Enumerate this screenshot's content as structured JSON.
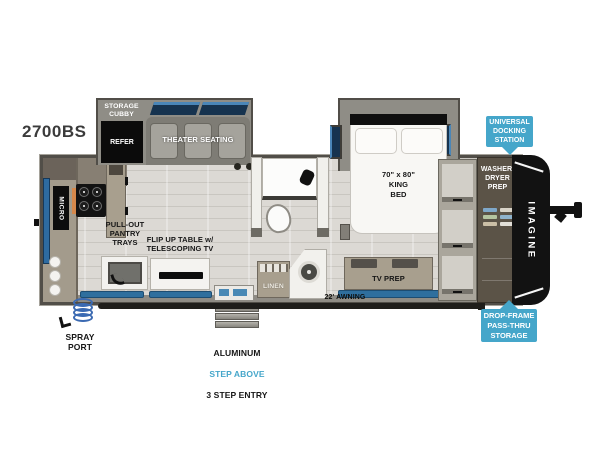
{
  "model": "2700BS",
  "badges": {
    "accessory_hitch": "ACCESSORY HITCH",
    "universal_docking_station": "UNIVERSAL\nDOCKING\nSTATION",
    "drop_frame_pass_thru_storage": "DROP-FRAME\nPASS-THRU\nSTORAGE"
  },
  "features": {
    "storage_cubby": "STORAGE\nCUBBY",
    "refrigerator": "REFER",
    "theater_seating": "THEATER SEATING",
    "king_bed": "70\" x 80\"\nKING\nBED",
    "microwave": "MICRO",
    "pull_out_pantry": "PULL-OUT\nPANTRY\nTRAYS",
    "flip_up_table": "FLIP UP TABLE w/\nTELESCOPING TV",
    "linen": "LINEN",
    "tv_prep": "TV PREP",
    "washer_dryer_prep": "WASHER/\nDRYER\nPREP",
    "awning": "22' AWNING",
    "brand_graphic": "IMAGINE"
  },
  "callouts": {
    "spray_port": "SPRAY\nPORT",
    "entry_step_material": "ALUMINUM",
    "entry_step_feature": "STEP ABOVE",
    "entry_step_count": "3 STEP ENTRY"
  },
  "colors": {
    "badge_blue": "#45a6ca",
    "window_navy": "#16334f",
    "mat_blue": "#2f6f9e",
    "cap_black": "#121212",
    "floor_gray": "#dcd9d4"
  }
}
